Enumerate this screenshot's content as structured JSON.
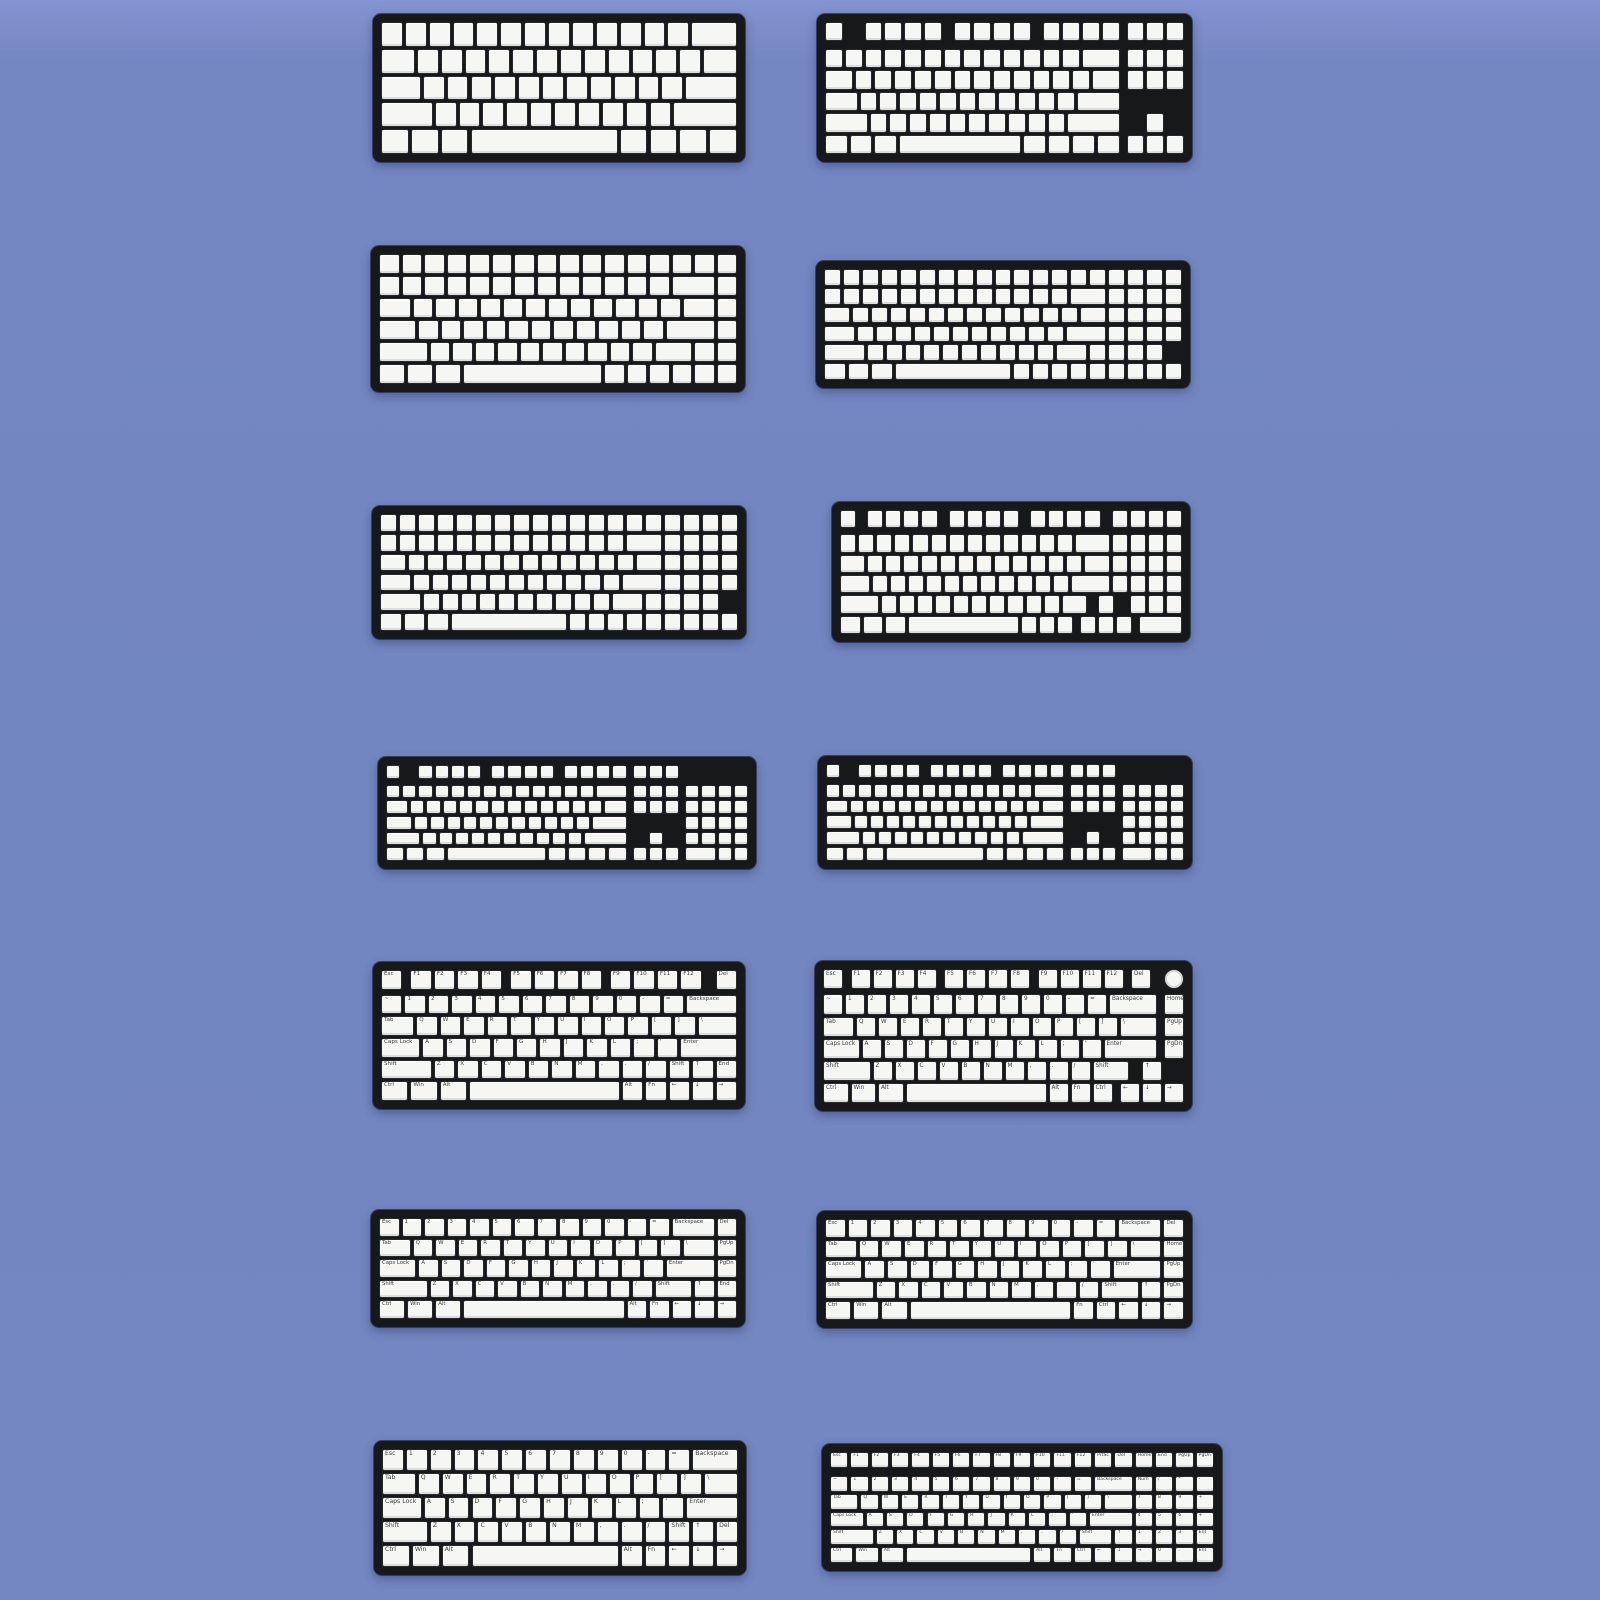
{
  "page": {
    "description": "Product image: fourteen mechanical keyboard layout diagrams (blank and legended keycap sets) arranged in a 7x2 grid on a periwinkle background",
    "background_color": "#7286c0"
  },
  "style": {
    "plate_color": "#17181a",
    "keycap_color": "#f6f6f4",
    "key_border_color": "#27292c",
    "legend_color": "#3c3d40"
  },
  "keyboards": [
    {
      "name": "keyboard-60-percent-blank",
      "type": "60% blank",
      "box": {
        "x": 373,
        "y": 14,
        "w": 372,
        "h": 148
      },
      "rows": [
        "13*1 2",
        "1.5 12*1 1.5",
        "1.75 11*1 2.25",
        "2.25 10*1 2.75",
        "1.25 1.25 1.25 6.25 1.25 1.25 1.25 1.25"
      ]
    },
    {
      "name": "keyboard-tkl-blank",
      "type": "TKL 87-key blank",
      "box": {
        "x": 817,
        "y": 14,
        "w": 375,
        "h": 148
      },
      "rows": [
        "1 g1 4*1 g0.5 4*1 g0.5 4*1 g0.25 3*1",
        {
          "mt": 0.25,
          "k": "13*1 2 g0.25 3*1"
        },
        "1.5 12*1 1.5 g0.25 3*1",
        "1.75 11*1 2.25",
        "2.25 10*1 2.75 g1.25 1",
        "1.25 1.25 1.25 6.25 1.25 1.25 1.25 1.25 g0.25 3*1"
      ]
    },
    {
      "name": "keyboard-75-percent-dense-blank",
      "type": "75% packed blank",
      "box": {
        "x": 371,
        "y": 246,
        "w": 374,
        "h": 146
      },
      "rows": [
        "16*1",
        "13*1 2 1",
        "1.5 12*1 1.5 1",
        "1.75 11*1 2.25 1",
        "2.25 10*1 1.75 1 1",
        "1.25 1.25 1.25 6.25 6*1"
      ]
    },
    {
      "name": "keyboard-96-percent-dense-blank-a",
      "type": "96% packed blank",
      "box": {
        "x": 816,
        "y": 261,
        "w": 374,
        "h": 127
      },
      "rows": [
        "19*1",
        "13*1 2 4*1",
        "1.5 12*1 1.5 4*1",
        "1.75 11*1 2.25 4*1",
        "2.25 10*1 1.75 4*1",
        "1.25 1.25 1.25 6.25 9*1"
      ]
    },
    {
      "name": "keyboard-96-percent-dense-blank-b",
      "type": "96% packed blank",
      "box": {
        "x": 372,
        "y": 506,
        "w": 374,
        "h": 133
      },
      "rows": [
        "19*1",
        "13*1 2 4*1",
        "1.5 12*1 1.5 4*1",
        "1.75 11*1 2.25 4*1",
        "2.25 10*1 1.75 4*1",
        "1.25 1.25 1.25 6.25 9*1"
      ]
    },
    {
      "name": "keyboard-1800-compact-blank",
      "type": "1800/96% blank with F-row gaps and arrow pod",
      "box": {
        "x": 832,
        "y": 502,
        "w": 358,
        "h": 140
      },
      "rows": [
        "1 g0.5 4*1 g0.5 4*1 g0.5 4*1 g0.5 4*1",
        {
          "mt": 0.2,
          "k": "13*1 2 4*1"
        },
        "1.5 12*1 1.5 4*1",
        "1.75 11*1 2.25 4*1",
        "2.25 10*1 1.5 g0.5 1 g0.75 3*1",
        "1.25 1.25 1.25 6.25 3*1 g0.25 3*1 g0.25 2.5"
      ]
    },
    {
      "name": "keyboard-fullsize-blank-left",
      "type": "full-size 104-key blank",
      "box": {
        "x": 378,
        "y": 757,
        "w": 378,
        "h": 112
      },
      "rows": [
        "1 g1 4*1 g0.5 4*1 g0.5 4*1 g0.25 3*1",
        {
          "mt": 0.25,
          "k": "13*1 2 g0.25 3*1 g0.25 4*1"
        },
        "1.5 12*1 1.5 g0.25 3*1 g0.25 4*1",
        "1.75 11*1 2.25 g3.5 4*1",
        "2.25 10*1 2.75 g1.25 1 g1.25 4*1",
        "1.25 1.25 1.25 6.25 1.25 1.25 1.25 1.25 g0.25 3*1 g0.25 2 1 1"
      ]
    },
    {
      "name": "keyboard-fullsize-blank-right",
      "type": "full-size 104-key blank",
      "box": {
        "x": 818,
        "y": 756,
        "w": 374,
        "h": 113
      },
      "rows": [
        "1 g1 4*1 g0.5 4*1 g0.5 4*1 g0.25 3*1",
        {
          "mt": 0.25,
          "k": "13*1 2 g0.25 3*1 g0.25 4*1"
        },
        "1.5 12*1 1.5 g0.25 3*1 g0.25 4*1",
        "1.75 11*1 2.25 g3.5 4*1",
        "2.25 10*1 2.75 g1.25 1 g1.25 4*1",
        "1.25 1.25 1.25 6.25 1.25 1.25 1.25 1.25 g0.25 3*1 g0.25 2 1 1"
      ]
    },
    {
      "name": "keyboard-75-percent-legends",
      "type": "75% with printed legends",
      "box": {
        "x": 373,
        "y": 962,
        "w": 372,
        "h": 147
      },
      "rows": [
        "1:Esc g0.25 1:F1 1:F2 1:F3 1:F4 g0.25 1:F5 1:F6 1:F7 1:F8 g0.25 1:F9 1:F10 1:F11 1:F12 g0.5 1:Del",
        {
          "mt": 0.15,
          "k": "1:~ 1:1 1:2 1:3 1:4 1:5 1:6 1:7 1:8 1:9 1:0 1:- 1:= 2.25:Backspace"
        },
        "1.5:Tab 1:Q 1:W 1:E 1:R 1:T 1:Y 1:U 1:I 1:O 1:P 1:[ 1:] 1.75:\\",
        "1.75:Caps_Lock 1:A 1:S 1:D 1:F 1:G 1:H 1:J 1:K 1:L 1:; 1:' 2.5:Enter",
        "2.25:Shift 1:Z 1:X 1:C 1:V 1:B 1:N 1:M 1:, 1:. 1:/ 1:Shift 1:↑ 1:End",
        "1.25:Ctrl 1.25:Win 1.25:Alt 6.5 1:Alt 1:Fn 1:← 1:↓ 1:→"
      ]
    },
    {
      "name": "keyboard-75-percent-knob-legends",
      "type": "75% with rotary knob and printed legends",
      "box": {
        "x": 815,
        "y": 961,
        "w": 377,
        "h": 150
      },
      "rows": [
        "1:Esc g0.25 1:F1 1:F2 1:F3 1:F4 g0.25 1:F5 1:F6 1:F7 1:F8 g0.25 1:F9 1:F10 1:F11 1:F12 g0.25 1:Del g0.5 o1",
        {
          "mt": 0.15,
          "k": "1:~ 1:1 1:2 1:3 1:4 1:5 1:6 1:7 1:8 1:9 1:0 1:- 1:= 2.25:Backspace g0.25 1:Home"
        },
        "1.5:Tab 1:Q 1:W 1:E 1:R 1:T 1:Y 1:U 1:I 1:O 1:P 1:[ 1:] 1.75:\\ g0.25 1:PgUp",
        "1.75:Caps_Lock 1:A 1:S 1:D 1:F 1:G 1:H 1:J 1:K 1:L 1:; 1:' 2.5:Enter g0.25 1:PgDn",
        "2.25:Shift 1:Z 1:X 1:C 1:V 1:B 1:N 1:M 1:, 1:. 1:/ 1.75:Shift g0.5 1:↑",
        "1.25:Ctrl 1.25:Win 1.25:Alt 6.5 1:Alt 1:Fn 1:Ctrl g0.25 1:← 1:↓ 1:→"
      ]
    },
    {
      "name": "keyboard-65-percent-legends-left",
      "type": "65% 68-key with printed legends",
      "box": {
        "x": 371,
        "y": 1210,
        "w": 374,
        "h": 117
      },
      "rows": [
        "1:Esc 1:1 1:2 1:3 1:4 1:5 1:6 1:7 1:8 1:9 1:0 1:- 1:= 2:Backspace 1:Del",
        "1.5:Tab 1:Q 1:W 1:E 1:R 1:T 1:Y 1:U 1:I 1:O 1:P 1:[ 1:] 1.5:\\ 1:PgUp",
        "1.75:Caps_Lock 1:A 1:S 1:D 1:F 1:G 1:H 1:J 1:K 1:L 1:; 1:' 2.25:Enter 1:PgDn",
        "2.25:Shift 1:Z 1:X 1:C 1:V 1:B 1:N 1:M 1:, 1:. 1:/ 1.75:Shift 1:↑ 1:End",
        "1.25:Ctrl 1.25:Win 1.25:Alt 7.25 1:Alt 1:Fn 1:← 1:↓ 1:→"
      ]
    },
    {
      "name": "keyboard-65-percent-legends-right",
      "type": "65% 68-key with printed legends",
      "box": {
        "x": 817,
        "y": 1211,
        "w": 375,
        "h": 117
      },
      "rows": [
        "1:Esc 1:1 1:2 1:3 1:4 1:5 1:6 1:7 1:8 1:9 1:0 1:- 1:= 2:Backspace 1:Del",
        "1.5:Tab 1:Q 1:W 1:E 1:R 1:T 1:Y 1:U 1:I 1:O 1:P 1:[ 1:] 1.5:\\ 1:Home",
        "1.75:Caps_Lock 1:A 1:S 1:D 1:F 1:G 1:H 1:J 1:K 1:L 1:; 1:' 2.25:Enter 1:PgUp",
        "2.25:Shift 1:Z 1:X 1:C 1:V 1:B 1:N 1:M 1:, 1:. 1:/ 1.75:Shift 1:↑ 1:PgDn",
        "1.25:Ctrl 1.25:Win 1.25:Alt 7.25 1:Fn 1:Ctrl 1:← 1:↓ 1:→"
      ]
    },
    {
      "name": "keyboard-64-key-legends",
      "type": "64-key 60% with arrows and printed legends",
      "box": {
        "x": 374,
        "y": 1441,
        "w": 372,
        "h": 134
      },
      "rows": [
        "1:Esc 1:1 1:2 1:3 1:4 1:5 1:6 1:7 1:8 1:9 1:0 1:- 1:= 2:Backspace",
        "1.5:Tab 1:Q 1:W 1:E 1:R 1:T 1:Y 1:U 1:I 1:O 1:P 1:[ 1:] 1.5:\\",
        "1.75:Caps_Lock 1:A 1:S 1:D 1:F 1:G 1:H 1:J 1:K 1:L 1:; 1:' 2.25:Enter",
        "2:Shift 1:Z 1:X 1:C 1:V 1:B 1:N 1:M 1:, 1:. 1:/ 1:Shift 1:↑ 1:Del",
        "1.25:Ctrl 1.25:Win 1.25:Alt 6.25 1:Alt 1:Fn 1:← 1:↓ 1:→"
      ]
    },
    {
      "name": "keyboard-96-percent-legends",
      "type": "96% compact full-size with printed legends",
      "box": {
        "x": 822,
        "y": 1444,
        "w": 400,
        "h": 127
      },
      "rows": [
        "1:Esc 1:F1 1:F2 1:F3 1:F4 1:F5 1:F6 1:F7 1:F8 1:F9 1:F10 1:F11 1:F12 1:PrtSc 1:Del 1:Home 1:End 1:PgUp 1:PgDn",
        {
          "mt": 0.35,
          "k": "1:~ 1:1 1:2 1:3 1:4 1:5 1:6 1:7 1:8 1:9 1:0 1:- 1:= 2:Backspace 1:Num 1:/ 1:* 1:-"
        },
        "1.5:Tab 1:Q 1:W 1:E 1:R 1:T 1:Y 1:U 1:I 1:O 1:P 1:[ 1:] 1.5:\\ 1:7 1:8 1:9 1:+",
        "1.75:Caps_Lock 1:A 1:S 1:D 1:F 1:G 1:H 1:J 1:K 1:L 1:; 1:' 2.25:Enter 1:4 1:5 1:6 1:+",
        "2.25:Shift 1:Z 1:X 1:C 1:V 1:B 1:N 1:M 1:, 1:. 1:/ 1.75:Shift 1:↑ 1:1 1:2 1:3 1:Ent",
        "1.25:Ctrl 1.25:Win 1.25:Alt 6.25 1:Alt 1:Fn 1:Ctrl 1:← 1:↓ 1:→ 1:0 1:. 1:Ent"
      ]
    }
  ]
}
